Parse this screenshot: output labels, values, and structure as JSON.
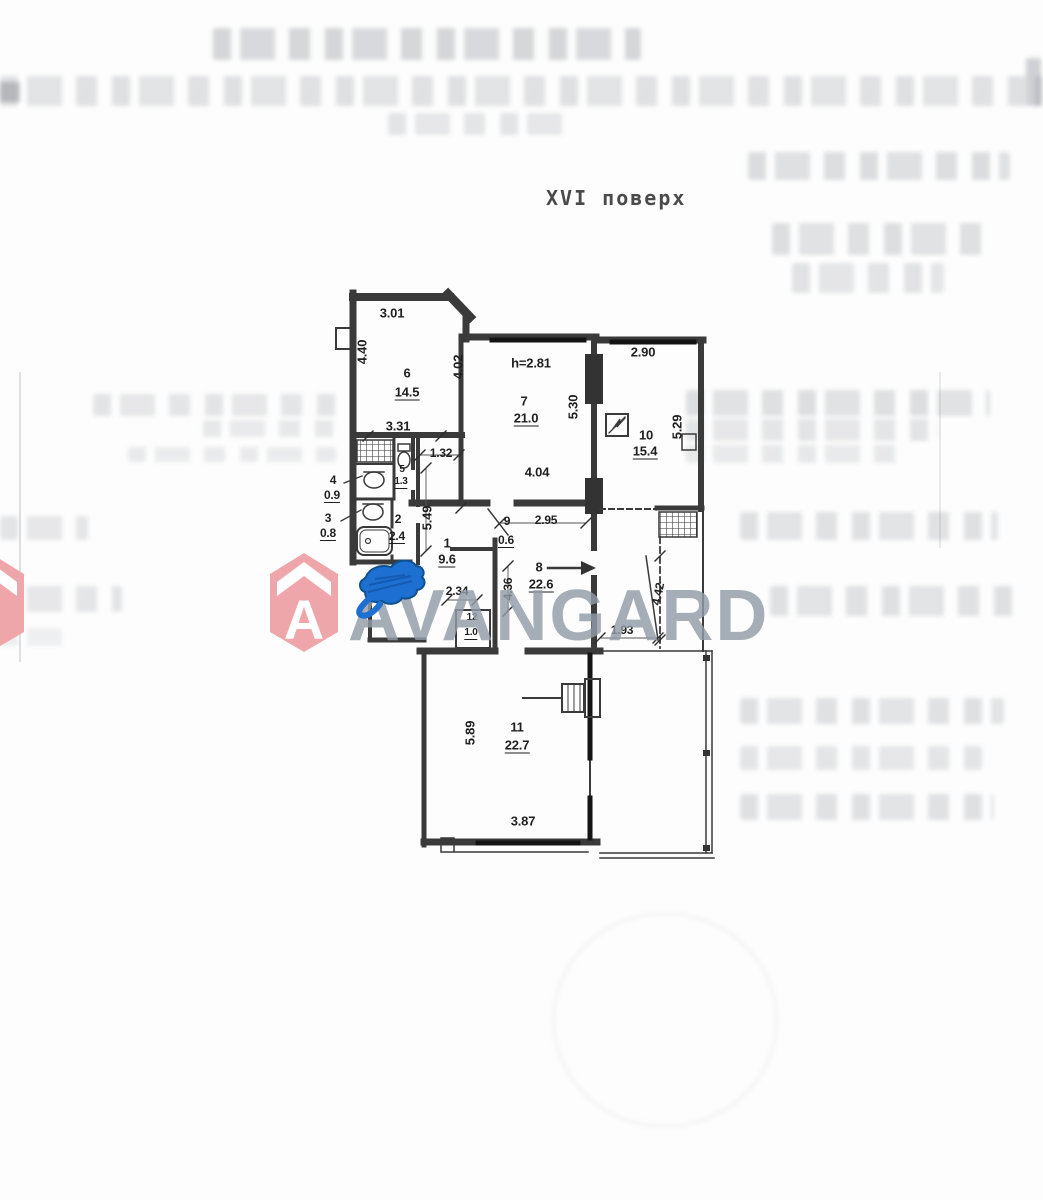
{
  "header": {
    "floor_label": "XVI поверх"
  },
  "watermark": {
    "brand": "AVANGARD",
    "logo_letter": "A",
    "brand_color": "#929da8",
    "logo_color": "#efa6ab"
  },
  "annotations": {
    "blue_scribble_color": "#1d6fd1"
  },
  "plan": {
    "wall_color": "#3a3a3a",
    "labels": [
      {
        "t": "3.01",
        "x": 392,
        "y": 313,
        "k": "dim"
      },
      {
        "t": "4.40",
        "x": 362,
        "y": 352,
        "r": -90,
        "k": "dim"
      },
      {
        "t": "6",
        "x": 407,
        "y": 373,
        "k": "num"
      },
      {
        "t": "14.5",
        "x": 407,
        "y": 393,
        "u": 1,
        "k": "area"
      },
      {
        "t": "4.02",
        "x": 458,
        "y": 367,
        "r": -90,
        "k": "dim"
      },
      {
        "t": "3.31",
        "x": 398,
        "y": 426,
        "k": "dim"
      },
      {
        "t": "1.32",
        "x": 441,
        "y": 453,
        "fs": 12,
        "k": "dim"
      },
      {
        "t": "5",
        "x": 402,
        "y": 470,
        "fs": 10,
        "k": "num"
      },
      {
        "t": "1.3",
        "x": 401,
        "y": 483,
        "fs": 10,
        "u": 1,
        "k": "area"
      },
      {
        "t": "4",
        "x": 333,
        "y": 480,
        "fs": 12,
        "k": "num"
      },
      {
        "t": "0.9",
        "x": 332,
        "y": 496,
        "fs": 12,
        "u": 1,
        "k": "area"
      },
      {
        "t": "3",
        "x": 328,
        "y": 518,
        "fs": 12,
        "k": "num"
      },
      {
        "t": "0.8",
        "x": 328,
        "y": 534,
        "fs": 12,
        "u": 1,
        "k": "area"
      },
      {
        "t": "2",
        "x": 398,
        "y": 519,
        "fs": 12,
        "k": "num"
      },
      {
        "t": "2.4",
        "x": 397,
        "y": 537,
        "fs": 12,
        "u": 1,
        "k": "area"
      },
      {
        "t": "5.49",
        "x": 427,
        "y": 518,
        "r": -90,
        "k": "dim"
      },
      {
        "t": "1",
        "x": 447,
        "y": 543,
        "k": "num"
      },
      {
        "t": "9.6",
        "x": 447,
        "y": 560,
        "u": 1,
        "k": "area"
      },
      {
        "t": "2.34",
        "x": 457,
        "y": 591,
        "fs": 12,
        "k": "dim"
      },
      {
        "t": "12",
        "x": 472,
        "y": 618,
        "fs": 10,
        "k": "num"
      },
      {
        "t": "1.0",
        "x": 471,
        "y": 634,
        "fs": 10,
        "u": 1,
        "k": "area"
      },
      {
        "t": "h=2.81",
        "x": 531,
        "y": 363,
        "k": "note"
      },
      {
        "t": "7",
        "x": 524,
        "y": 401,
        "k": "num"
      },
      {
        "t": "21.0",
        "x": 526,
        "y": 419,
        "u": 1,
        "k": "area"
      },
      {
        "t": "5.30",
        "x": 573,
        "y": 407,
        "r": -90,
        "k": "dim"
      },
      {
        "t": "4.04",
        "x": 537,
        "y": 472,
        "k": "dim"
      },
      {
        "t": "9",
        "x": 507,
        "y": 521,
        "fs": 12,
        "k": "num"
      },
      {
        "t": "2.95",
        "x": 546,
        "y": 520,
        "fs": 12,
        "k": "dim"
      },
      {
        "t": "0.6",
        "x": 506,
        "y": 541,
        "fs": 12,
        "u": 1,
        "k": "area"
      },
      {
        "t": "8",
        "x": 539,
        "y": 567,
        "k": "num"
      },
      {
        "t": "22.6",
        "x": 541,
        "y": 585,
        "u": 1,
        "k": "area"
      },
      {
        "t": "4.36",
        "x": 508,
        "y": 589,
        "r": -90,
        "fs": 12,
        "k": "dim"
      },
      {
        "t": "2.90",
        "x": 643,
        "y": 352,
        "k": "dim"
      },
      {
        "t": "10",
        "x": 646,
        "y": 435,
        "k": "num"
      },
      {
        "t": "15.4",
        "x": 645,
        "y": 452,
        "u": 1,
        "k": "area"
      },
      {
        "t": "5.29",
        "x": 677,
        "y": 427,
        "r": -90,
        "k": "dim"
      },
      {
        "t": "4.42",
        "x": 658,
        "y": 594,
        "r": -78,
        "fs": 12,
        "k": "dim"
      },
      {
        "t": "1.93",
        "x": 622,
        "y": 630,
        "fs": 12,
        "k": "dim"
      },
      {
        "t": "5.89",
        "x": 470,
        "y": 733,
        "r": -90,
        "k": "dim"
      },
      {
        "t": "11",
        "x": 517,
        "y": 727,
        "k": "num"
      },
      {
        "t": "22.7",
        "x": 517,
        "y": 746,
        "u": 1,
        "k": "area"
      },
      {
        "t": "3.87",
        "x": 523,
        "y": 821,
        "k": "dim"
      }
    ]
  }
}
